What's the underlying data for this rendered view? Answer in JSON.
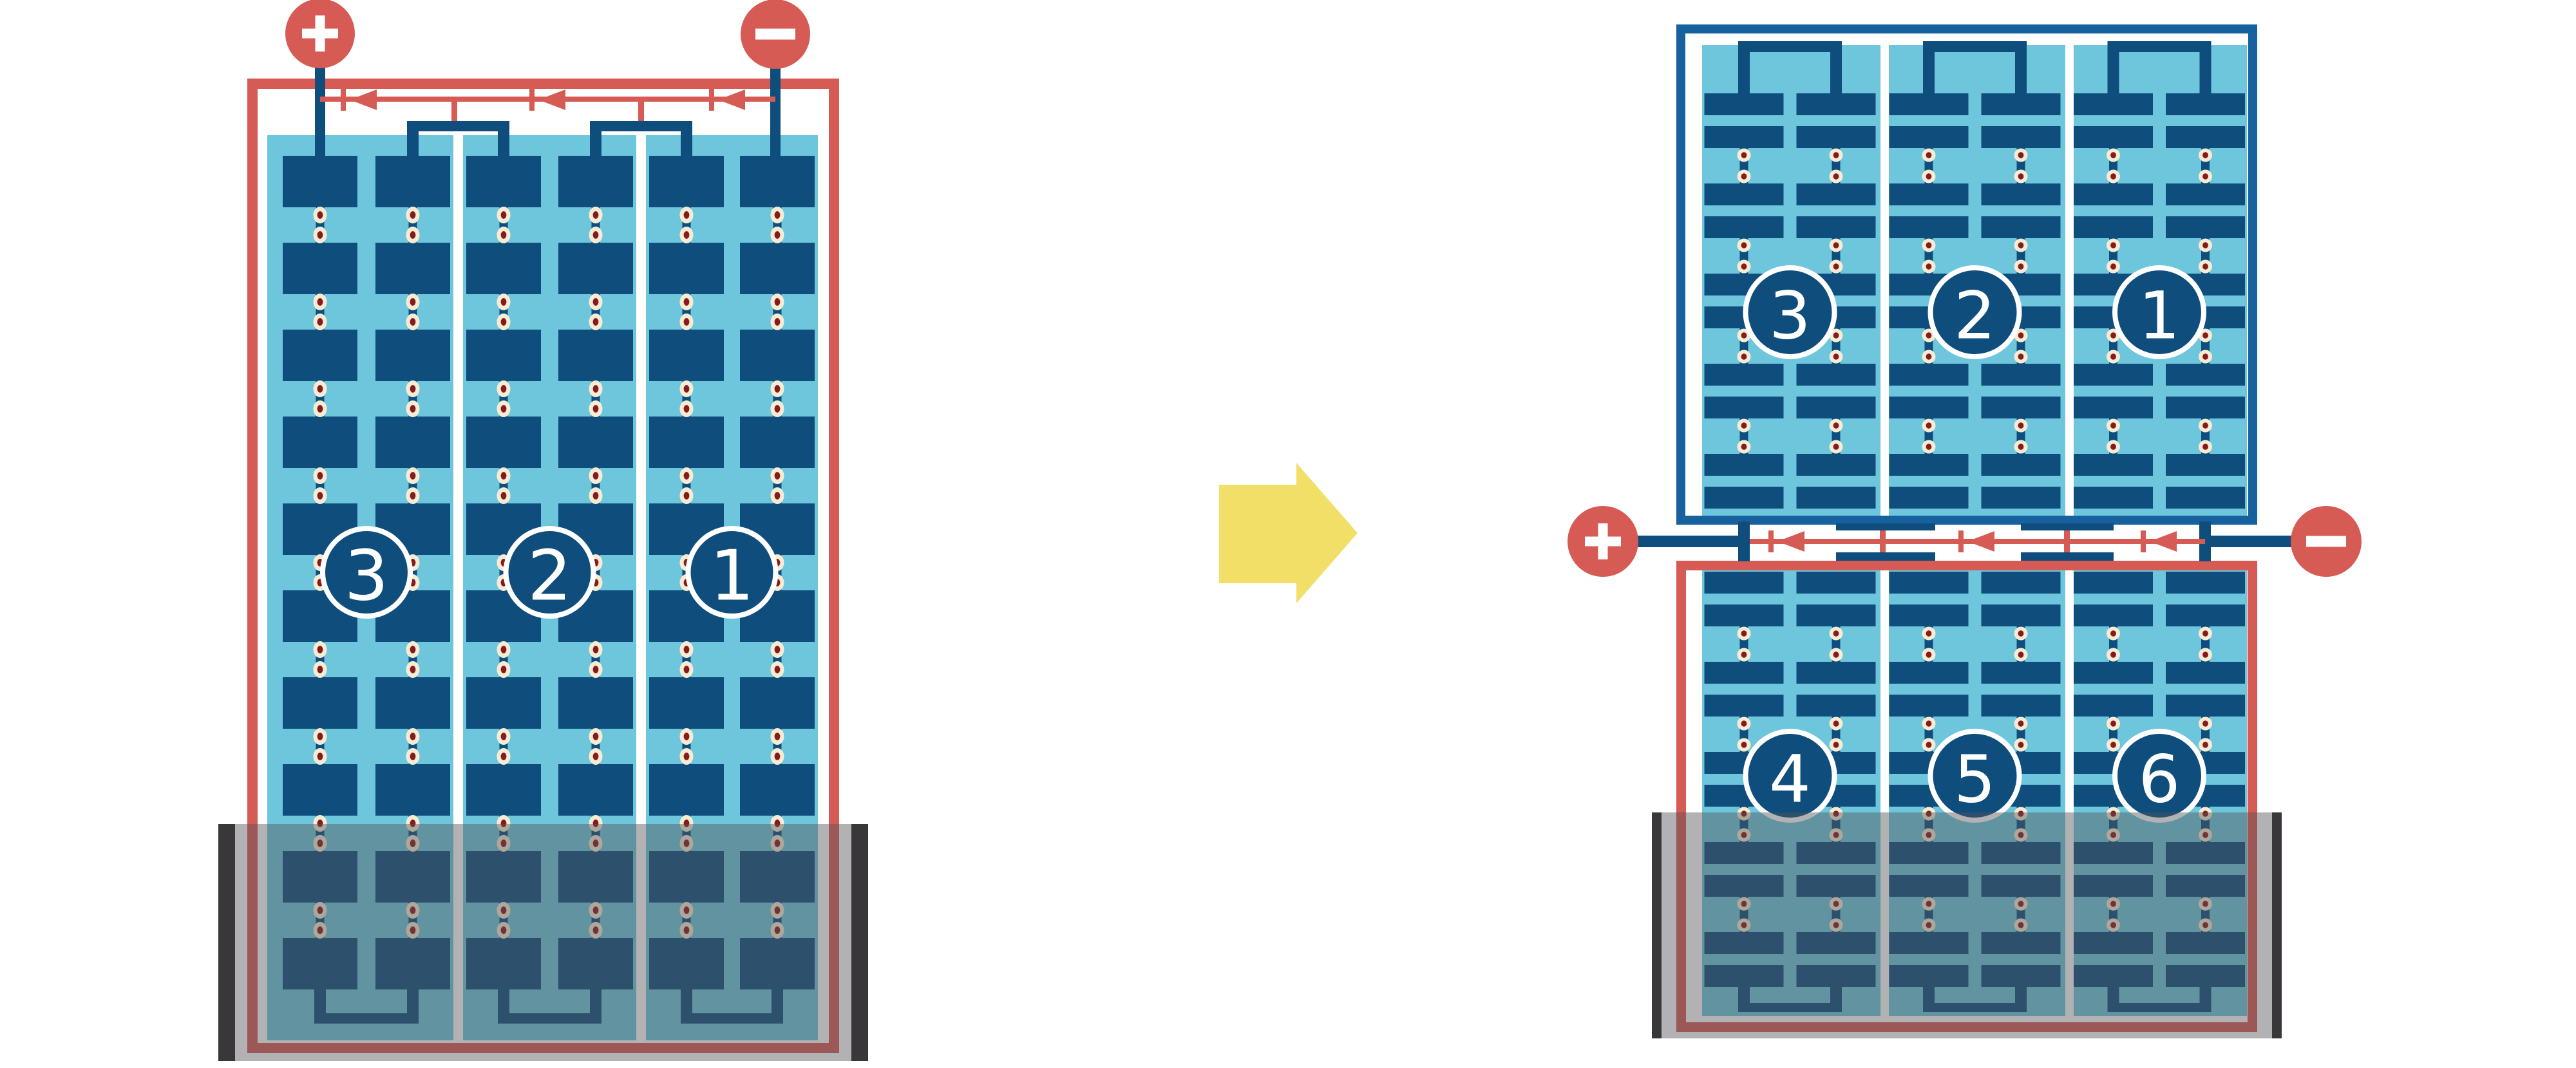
{
  "title": "Solar module string wiring comparison under bottom shading",
  "colors": {
    "wire_red": "#d65b54",
    "cell_navy": "#0e4d7c",
    "frame_blue": "#16619e",
    "panel_light_blue": "#6ec6dd",
    "solder_dot_cream": "#f6ecd4",
    "solder_dot_center": "#871a1d",
    "arrow_yellow": "#f1df68",
    "shadow_post_dark": "#3a373a",
    "shade_overlay": "rgba(85,85,88,0.45)"
  },
  "left_panel": {
    "description": "full-cell module, 3 series strings, shaded at bottom",
    "terminals": [
      {
        "symbol": "+"
      },
      {
        "symbol": "−"
      }
    ],
    "bypass_diodes": 3,
    "strings": [
      {
        "label": "3"
      },
      {
        "label": "2"
      },
      {
        "label": "1"
      }
    ],
    "shaded_bottom": true
  },
  "arrow": {
    "direction": "right"
  },
  "right_top_panel": {
    "description": "half-cut module upper half, unshaded",
    "strings": [
      {
        "label": "3"
      },
      {
        "label": "2"
      },
      {
        "label": "1"
      }
    ],
    "shaded_bottom": false
  },
  "right_bottom_panel": {
    "description": "half-cut module lower half, shaded at bottom",
    "strings": [
      {
        "label": "4"
      },
      {
        "label": "5"
      },
      {
        "label": "6"
      }
    ],
    "shaded_bottom": true
  },
  "junction": {
    "description": "center junction between half-cut panel halves",
    "terminals": [
      {
        "symbol": "+"
      },
      {
        "symbol": "−"
      }
    ],
    "bypass_diodes": 3
  }
}
